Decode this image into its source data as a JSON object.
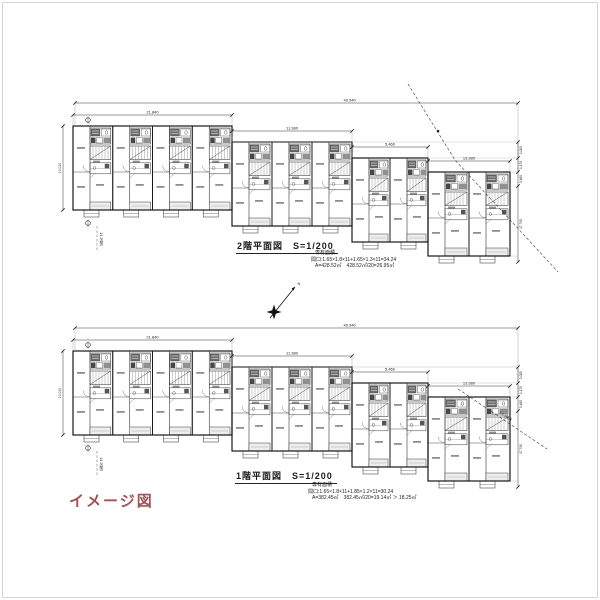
{
  "colors": {
    "ink": "#1a1a1a",
    "thin": "#3a3a3a",
    "dim": "#222222",
    "caption": "#a05353",
    "frame": "#d6d6d6"
  },
  "caption": "イメージ図",
  "north_label": "N",
  "floors": [
    {
      "id": "2f",
      "title": "2階平面図",
      "scale_label": "S=1/200",
      "notes": [
        "専有面積",
        "間口:1.65×1.8×11+1.65×1.3×11=34.24",
        "A=428.52㎡　428.52㎡/20=26.95㎡"
      ],
      "dims": {
        "total": "40.940",
        "tiers": [
          "21.840",
          "11.380",
          "5.460",
          "13.380"
        ],
        "left": "10.010",
        "right_segments": [
          "1.000",
          "1.170",
          "5.460"
        ],
        "right_total": "17.790"
      },
      "slope_label": "1:1.5傾斜",
      "tiers": [
        {
          "modules": 4
        },
        {
          "modules": 3
        },
        {
          "modules": 2
        },
        {
          "modules": 2
        }
      ]
    },
    {
      "id": "1f",
      "title": "1階平面図",
      "scale_label": "S=1/200",
      "notes": [
        "専有面積",
        "間口:1.65×1.8×11+1.85×1.2×11=30.24",
        "A=382.45㎡　382.45㎡/20=19.14㎡ ＞ 18.25㎡"
      ],
      "dims": {
        "total": "40.940",
        "tiers": [
          "21.840",
          "11.380",
          "5.460",
          "13.380"
        ],
        "left": "10.010",
        "right_segments": [
          "1.000",
          "1.170",
          "5.460"
        ],
        "right_total": "17.790"
      },
      "slope_label": "1:1.5傾斜",
      "tiers": [
        {
          "modules": 4
        },
        {
          "modules": 3
        },
        {
          "modules": 2
        },
        {
          "modules": 2
        }
      ]
    }
  ]
}
